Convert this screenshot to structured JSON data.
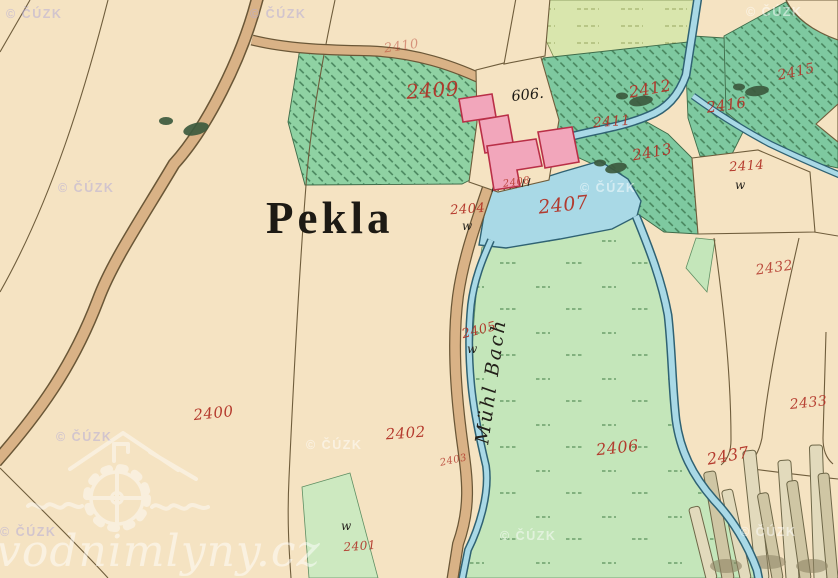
{
  "map": {
    "region_label": "Pekla",
    "house_number": "606.",
    "stream_name": "Mühl Bach",
    "w_symbol": "w",
    "watermark": {
      "text": "© ČÚZK",
      "positions": [
        {
          "x": 6,
          "y": 18,
          "v": "lav"
        },
        {
          "x": 250,
          "y": 18,
          "v": "lav"
        },
        {
          "x": 746,
          "y": 16,
          "v": "light"
        },
        {
          "x": 58,
          "y": 192,
          "v": "lav"
        },
        {
          "x": 580,
          "y": 192,
          "v": "light"
        },
        {
          "x": 56,
          "y": 441,
          "v": "lav"
        },
        {
          "x": 306,
          "y": 449,
          "v": "light"
        },
        {
          "x": 0,
          "y": 536,
          "v": "lav"
        },
        {
          "x": 500,
          "y": 540,
          "v": "light"
        },
        {
          "x": 740,
          "y": 536,
          "v": "light"
        }
      ]
    },
    "brand": {
      "text": "vodnimlyny.cz"
    },
    "parcel_labels": [
      {
        "n": "2410",
        "x": 402,
        "y": 50,
        "s": 13,
        "r": -8,
        "o": 0.45
      },
      {
        "n": "2409",
        "x": 433,
        "y": 97,
        "s": 20,
        "r": -4,
        "o": 0.95
      },
      {
        "n": "2412",
        "x": 651,
        "y": 94,
        "s": 16,
        "r": -10,
        "o": 0.95
      },
      {
        "n": "2415",
        "x": 797,
        "y": 76,
        "s": 14,
        "r": -12,
        "o": 0.9
      },
      {
        "n": "2416",
        "x": 727,
        "y": 110,
        "s": 15,
        "r": -8,
        "o": 0.95
      },
      {
        "n": "2411",
        "x": 612,
        "y": 126,
        "s": 14,
        "r": -4,
        "o": 0.9
      },
      {
        "n": "2413",
        "x": 653,
        "y": 157,
        "s": 15,
        "r": -10,
        "o": 0.95
      },
      {
        "n": "2414",
        "x": 747,
        "y": 170,
        "s": 13,
        "r": -4,
        "o": 0.95
      },
      {
        "n": "2408",
        "x": 517,
        "y": 185,
        "s": 10,
        "r": -8,
        "o": 0.85
      },
      {
        "n": "2404",
        "x": 468,
        "y": 213,
        "s": 13,
        "r": -4,
        "o": 0.95
      },
      {
        "n": "2407",
        "x": 564,
        "y": 211,
        "s": 19,
        "r": -6,
        "o": 0.95
      },
      {
        "n": "2432",
        "x": 775,
        "y": 272,
        "s": 14,
        "r": -8,
        "o": 0.85
      },
      {
        "n": "2405",
        "x": 480,
        "y": 334,
        "s": 13,
        "r": -14,
        "o": 0.95
      },
      {
        "n": "2400",
        "x": 214,
        "y": 418,
        "s": 15,
        "r": -6,
        "o": 0.95
      },
      {
        "n": "2402",
        "x": 406,
        "y": 438,
        "s": 15,
        "r": -4,
        "o": 0.95
      },
      {
        "n": "2403",
        "x": 454,
        "y": 463,
        "s": 10,
        "r": -12,
        "o": 0.8
      },
      {
        "n": "2406",
        "x": 618,
        "y": 453,
        "s": 16,
        "r": -6,
        "o": 0.95
      },
      {
        "n": "2437",
        "x": 729,
        "y": 461,
        "s": 16,
        "r": -10,
        "o": 0.95
      },
      {
        "n": "2433",
        "x": 809,
        "y": 407,
        "s": 14,
        "r": -6,
        "o": 0.9
      },
      {
        "n": "2401",
        "x": 360,
        "y": 550,
        "s": 12,
        "r": -4,
        "o": 0.9
      }
    ],
    "w_marks": [
      {
        "x": 462,
        "y": 230
      },
      {
        "x": 467,
        "y": 353
      },
      {
        "x": 735,
        "y": 189
      },
      {
        "x": 341,
        "y": 530
      }
    ],
    "colors": {
      "paper": "#f5e3c2",
      "road": "#d9b286",
      "road-edge": "#6a5737",
      "water": "#a9d9e6",
      "water-edge": "#2f6273",
      "green-hatched": "#8fd2a3",
      "green-dark": "#7ec9a0",
      "meadow": "#c4e6ba",
      "yellow-green": "#d9e6ad",
      "building": "#f2a6bb",
      "building-edge": "#b92f47",
      "label-red": "#b23327",
      "ink": "#25221c",
      "boundary": "#6f5d3c",
      "watermark-light": "#ffffff",
      "watermark-lavender": "#b7aed6"
    }
  }
}
